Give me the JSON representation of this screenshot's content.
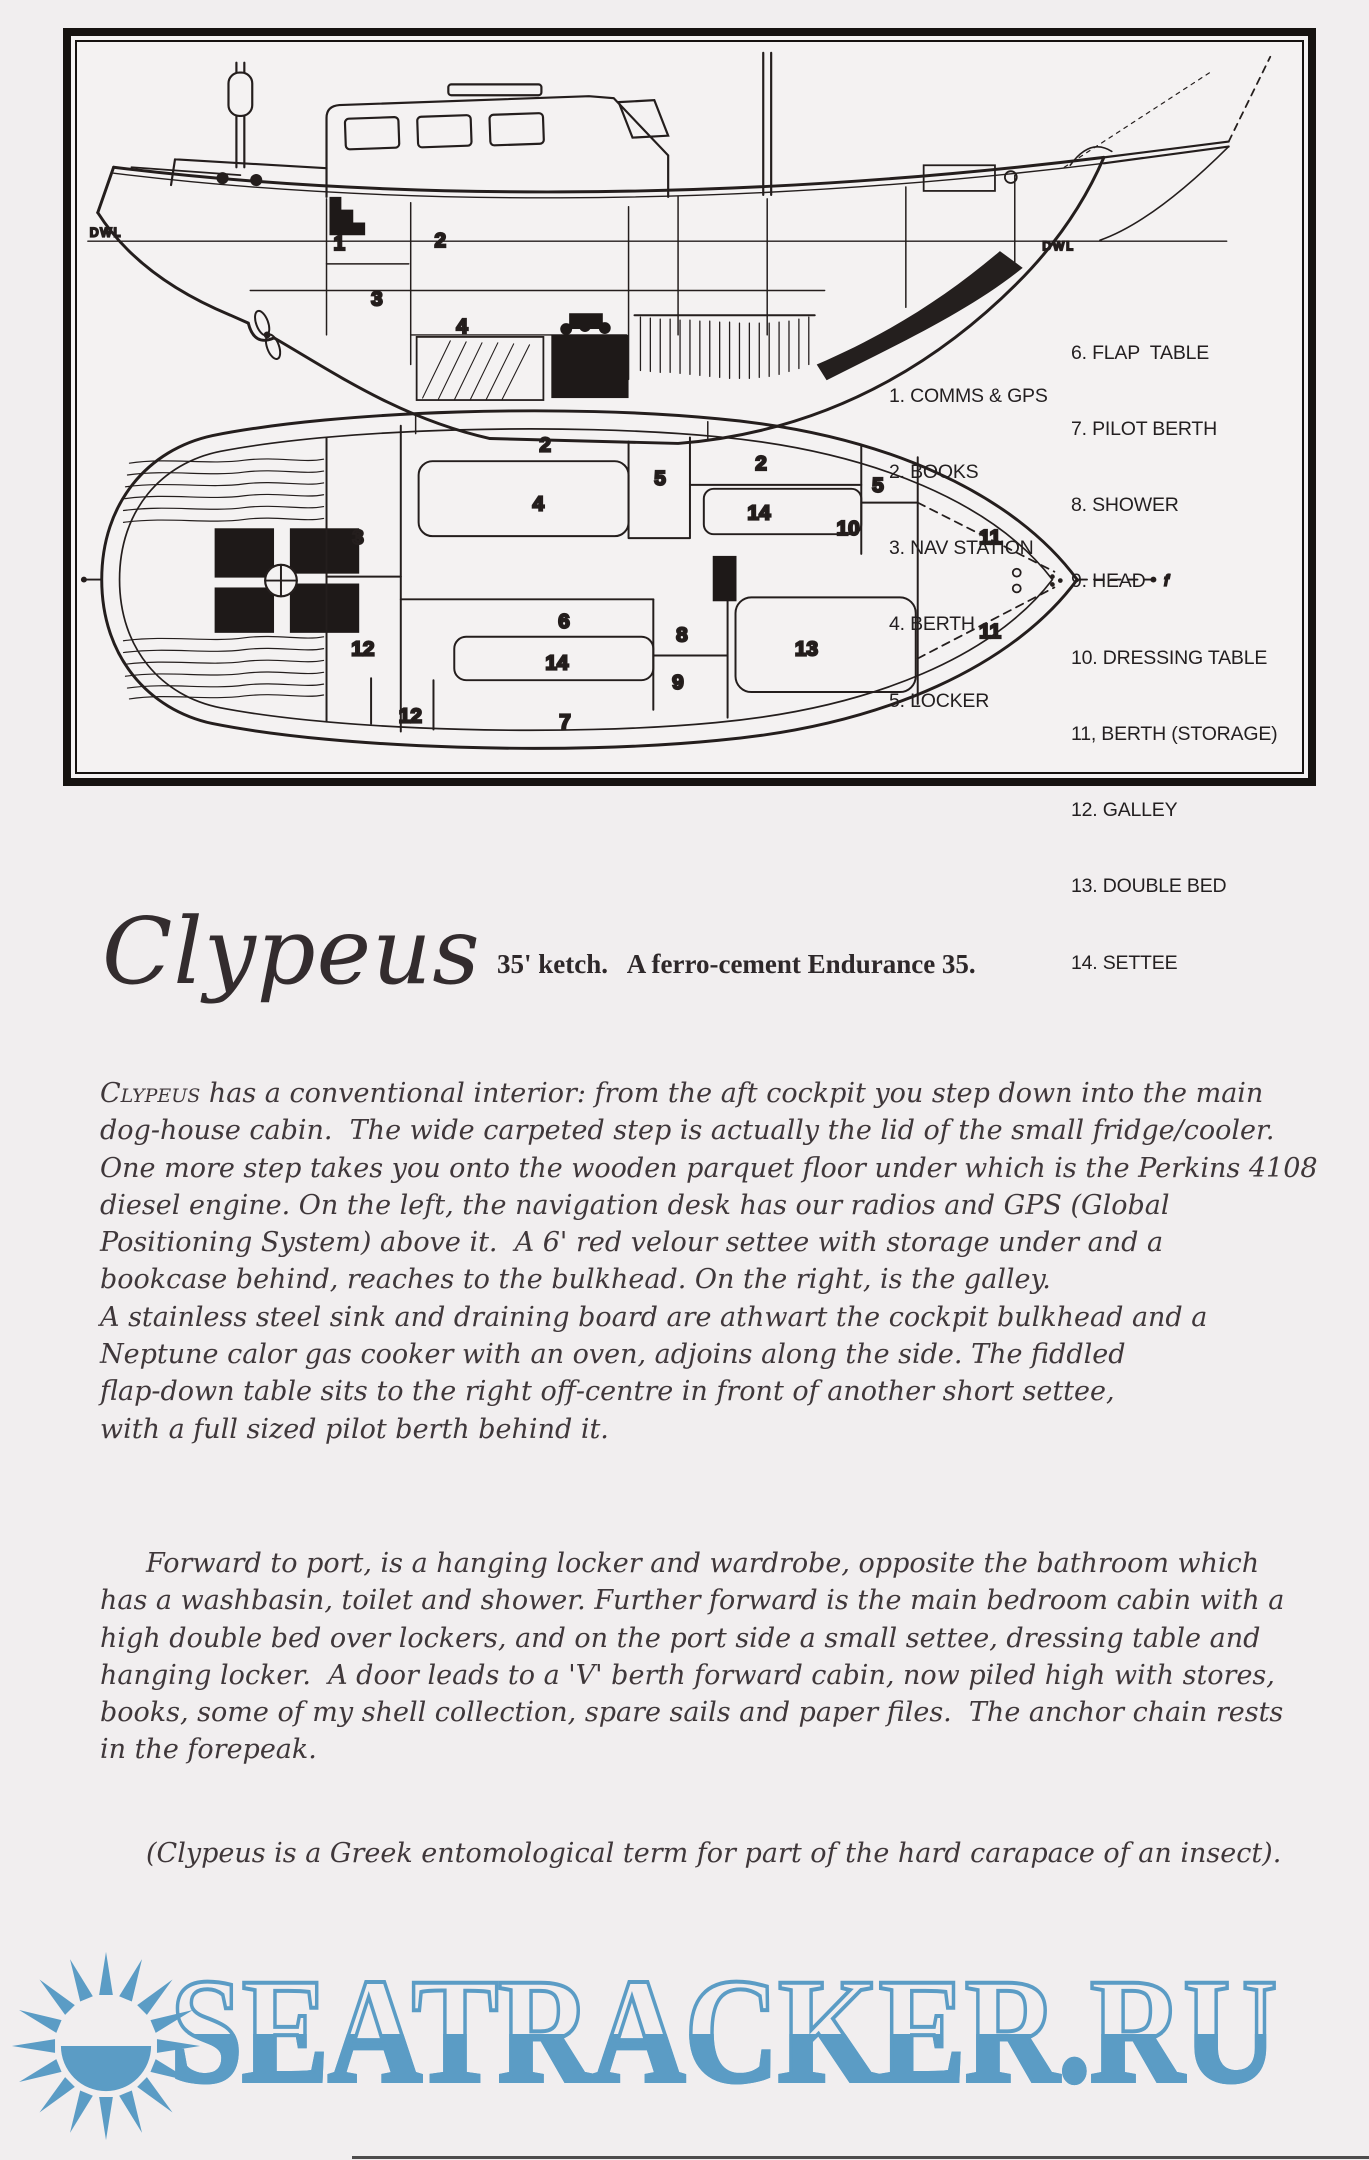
{
  "colors": {
    "accent_blue": "#5b9cc5",
    "ink": "#241e1d",
    "page": "#f1eeef"
  },
  "diagram": {
    "legend_left": [
      "1. COMMS & GPS",
      "2. BOOKS",
      "3. NAV STATION",
      "4. BERTH",
      "5. LOCKER"
    ],
    "legend_right": [
      "6. FLAP  TABLE",
      "7. PILOT BERTH",
      "8. SHOWER",
      "9. HEAD",
      "10. DRESSING TABLE",
      "11, BERTH (STORAGE)",
      "12. GALLEY",
      "13. DOUBLE BED",
      "14. SETTEE"
    ],
    "profile_labels": [
      "1",
      "2",
      "3",
      "4"
    ],
    "plan_labels": [
      "2",
      "4",
      "5",
      "2",
      "14",
      "5",
      "10",
      "11",
      "3",
      "12",
      "6",
      "8",
      "14",
      "9",
      "13",
      "11",
      "12",
      "7"
    ],
    "dwl": "DWL",
    "bow_mark": "f"
  },
  "title": {
    "name": "Clypeus",
    "subtitle": "35' ketch.   A ferro-cement Endurance 35."
  },
  "body": {
    "p1_lead": "Clypeus",
    "p1_lines": [
      " has a conventional interior: from the aft cockpit you step down into the main",
      "dog-house cabin.  The wide carpeted step is actually the lid of the small fridge/cooler.",
      "One more step takes you onto the wooden parquet floor under which is the Perkins 4108",
      "diesel engine. On the left, the navigation desk has our radios and GPS (Global",
      "Positioning System) above it.  A 6' red velour settee with storage under and a",
      "bookcase behind, reaches to the bulkhead. On the right, is the galley.",
      "A stainless steel sink and draining board are athwart the cockpit bulkhead and a",
      "Neptune calor gas cooker with an oven, adjoins along the side. The fiddled",
      "flap-down table sits to the right off-centre in front of another short settee,",
      "with a full sized pilot berth behind it."
    ],
    "p2_lines": [
      "Forward to port, is a hanging locker and wardrobe, opposite the bathroom which",
      "has a washbasin, toilet and shower. Further forward is the main bedroom cabin with a",
      "high double bed over lockers, and on the port side a small settee, dressing table and",
      "hanging locker.  A door leads to a 'V' berth forward cabin, now piled high with stores,",
      "books, some of my shell collection, spare sails and paper files.  The anchor chain rests",
      "in the forepeak."
    ],
    "p3": "(Clypeus is a Greek entomological term for part of the hard carapace of an insect)."
  },
  "watermark": {
    "text": "SEATRACKER.RU",
    "sun_icon": "sun-icon"
  }
}
